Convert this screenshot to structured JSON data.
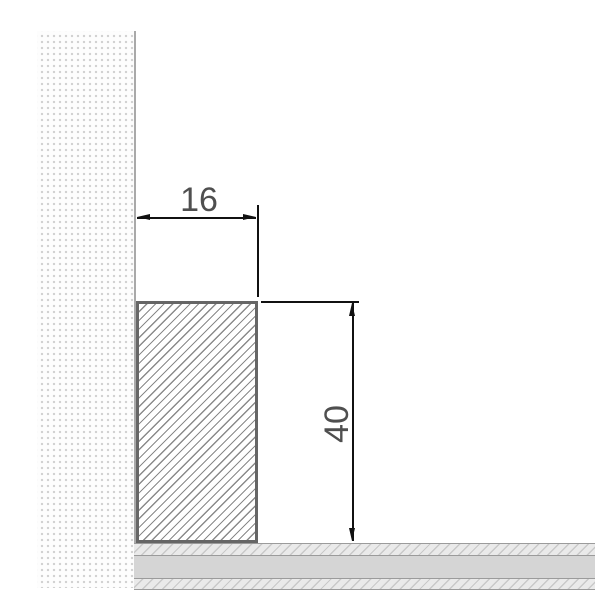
{
  "dimensions": {
    "width": {
      "value": "16",
      "orientation": "horizontal"
    },
    "height": {
      "value": "40",
      "orientation": "vertical"
    }
  },
  "colors": {
    "background": "#ffffff",
    "dimension_line": "#111111",
    "dimension_text": "#4f4f4f",
    "profile_border": "#666666",
    "profile_hatch": "#8a8a8a",
    "wall_dot": "#d2d2d2",
    "wall_edge": "#a9a9a9",
    "floor_line": "#9b9b9b",
    "floor_solid_fill": "#d5d5d5",
    "floor_hatch_fill": "#eaeaea",
    "floor_hatch_line": "#c9c9c9"
  }
}
